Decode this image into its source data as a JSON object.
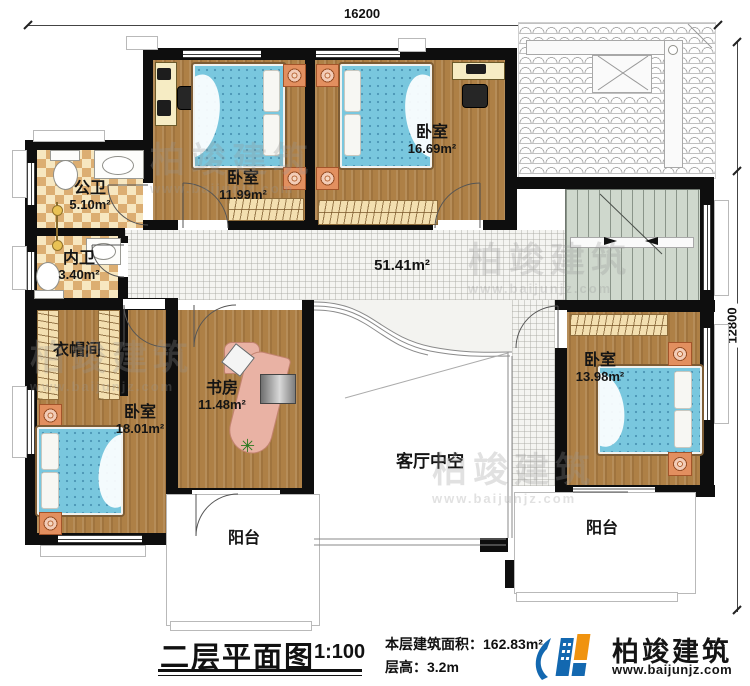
{
  "dimensions": {
    "width_top": "16200",
    "height_right": "12800"
  },
  "rooms": [
    {
      "id": "bedroom-top-left",
      "name": "卧室",
      "area": "11.99m²"
    },
    {
      "id": "bedroom-top-right",
      "name": "卧室",
      "area": "16.69m²"
    },
    {
      "id": "public-bathroom",
      "name": "公卫",
      "area": "5.10m²"
    },
    {
      "id": "inner-bathroom",
      "name": "内卫",
      "area": "3.40m²"
    },
    {
      "id": "cloakroom",
      "name": "衣帽间",
      "area": ""
    },
    {
      "id": "bedroom-bottom-left",
      "name": "卧室",
      "area": "18.01m²"
    },
    {
      "id": "study",
      "name": "书房",
      "area": "11.48m²"
    },
    {
      "id": "bedroom-bottom-right",
      "name": "卧室",
      "area": "13.98m²"
    }
  ],
  "hall": {
    "area": "51.41m²"
  },
  "void": {
    "label": "客厅中空"
  },
  "balconies": {
    "left": "阳台",
    "right": "阳台"
  },
  "footer": {
    "title": "二层平面图",
    "scale": "1:100",
    "area_line": "本层建筑面积：162.83m²",
    "height_line": "层高：3.2m",
    "brand": "柏竣建筑",
    "website": "www.baijunjz.com"
  },
  "watermark": {
    "brand": "柏竣建筑",
    "website": "www.baijunjz.com"
  },
  "colors": {
    "wall": "#0e0e0e",
    "wood_floor": "#ae8046",
    "tile_floor": "#f4f4f1",
    "bathroom_tile": "#dcae72",
    "balcony_tile": "#efebd7",
    "stair": "#cfd8cd",
    "bed": "#79c7de",
    "nightstand": "#e28f5f",
    "logo_blue": "#1368b0",
    "logo_orange": "#f0930f"
  }
}
